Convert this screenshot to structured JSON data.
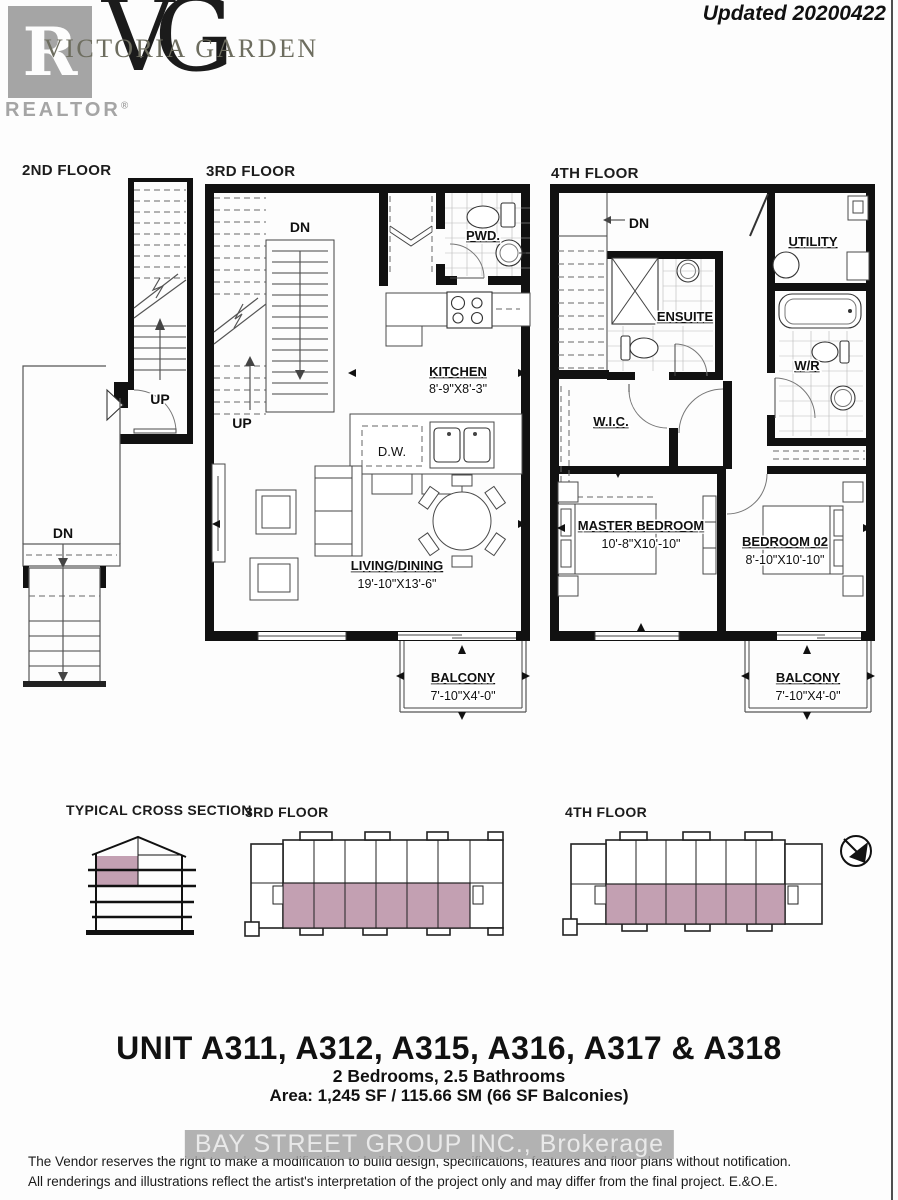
{
  "header": {
    "updated": "Updated 20200422",
    "realtor_logo": {
      "letter": "R",
      "label": "REALTOR",
      "registered": "®"
    },
    "brand": {
      "monogram": "VG",
      "name": "VICTORIA GARDEN"
    }
  },
  "floors": {
    "second": {
      "title": "2ND FLOOR",
      "up": "UP",
      "dn": "DN"
    },
    "third": {
      "title": "3RD FLOOR",
      "dn": "DN",
      "up": "UP",
      "pwd": "PWD.",
      "kitchen": "KITCHEN",
      "kitchen_dims": "8'-9\"X8'-3\"",
      "dw": "D.W.",
      "living": "LIVING/DINING",
      "living_dims": "19'-10\"X13'-6\"",
      "balcony": "BALCONY",
      "balcony_dims": "7'-10\"X4'-0\""
    },
    "fourth": {
      "title": "4TH FLOOR",
      "dn": "DN",
      "utility": "UTILITY",
      "ensuite": "ENSUITE",
      "wr": "W/R",
      "wic": "W.I.C.",
      "master": "MASTER BEDROOM",
      "master_dims": "10'-8\"X10'-10\"",
      "bedroom2": "BEDROOM 02",
      "bedroom2_dims": "8'-10\"X10'-10\"",
      "balcony": "BALCONY",
      "balcony_dims": "7'-10\"X4'-0\""
    }
  },
  "keyplans": {
    "cross_section_title": "TYPICAL CROSS SECTION",
    "third_title": "3RD FLOOR",
    "fourth_title": "4TH FLOOR"
  },
  "unit_info": {
    "title": "UNIT A311, A312, A315, A316, A317 & A318",
    "subtitle": "2 Bedrooms, 2.5 Bathrooms",
    "area": "Area: 1,245 SF / 115.66 SM (66 SF Balconies)"
  },
  "footer": {
    "watermark": "BAY STREET GROUP INC., Brokerage",
    "disclaimer1": "The Vendor reserves the right to make a modification to build design, specifications, features and floor plans without notification.",
    "disclaimer2": "All renderings and illustrations reflect the artist's interpretation of the project only and may differ from the final project. E.&O.E."
  },
  "colors": {
    "highlight": "#c3a0b2",
    "wall": "#111111",
    "logo_gray": "#a5a5a5",
    "brand_text": "#6d6d5f"
  }
}
